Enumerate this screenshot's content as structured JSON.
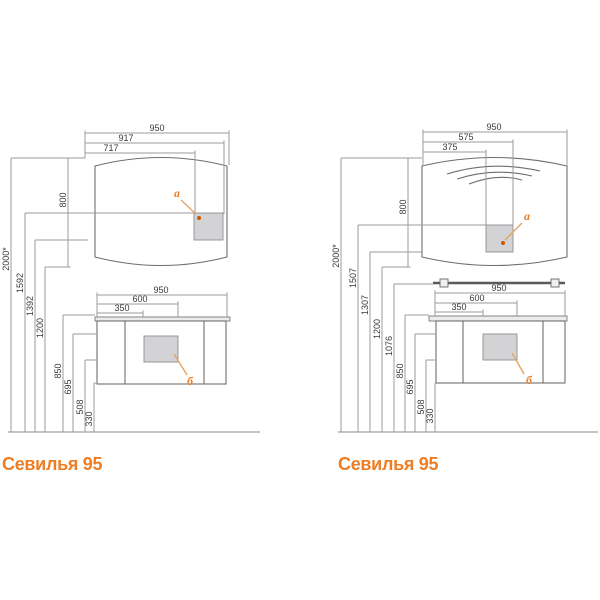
{
  "accent": "#ee7d24",
  "left": {
    "title": "Севилья 95",
    "labels": {
      "a": "a",
      "b": "б"
    },
    "mirror": {
      "w_full": "950",
      "w_switch_right": "917",
      "w_switch_left": "717",
      "height": "800"
    },
    "heights": {
      "total": "2000*",
      "h1": "1592",
      "h2": "1392",
      "h3": "1200"
    },
    "cabinet": {
      "w_full": "950",
      "w2": "600",
      "w1": "350",
      "h_top": "850",
      "h2": "695",
      "h3": "508",
      "h4": "330"
    }
  },
  "right": {
    "title": "Севилья 95",
    "labels": {
      "a": "a",
      "b": "б"
    },
    "mirror": {
      "w_full": "950",
      "w2": "575",
      "w1": "375",
      "height": "800"
    },
    "heights": {
      "total": "2000*",
      "h1": "1507",
      "h2": "1307",
      "h3": "1200",
      "shelf": "1076"
    },
    "cabinet": {
      "w_full": "950",
      "w2": "600",
      "w1": "350",
      "h_top": "850",
      "h2": "695",
      "h3": "508",
      "h4": "330"
    }
  }
}
